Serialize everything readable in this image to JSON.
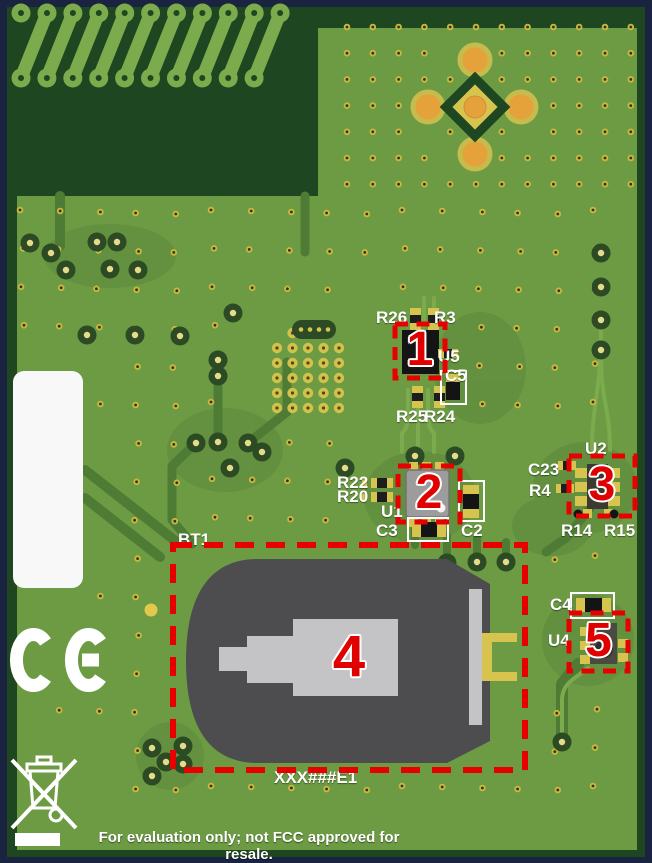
{
  "figure": {
    "description": "Annotated PCB evaluation board photo with five numbered callout regions",
    "bottom_notice": "For evaluation only; not FCC approved for resale.",
    "board_code_label": "XXX###E1"
  },
  "marks": {
    "ce": "CE",
    "weee": "crossed-out-wheeled-bin"
  },
  "colors": {
    "background_navy": "#1a2440",
    "board_dark_green": "#1e4620",
    "board_green": "#6d9b44",
    "trace_light_green": "#7cab4d",
    "trace_dark_green": "#4e7c34",
    "pad_yellow": "#d6c44e",
    "via_yellow": "#c9b83f",
    "button_orange": "#e5a23b",
    "annotation_red": "#e80000",
    "battery_gray": "#4d4d4f",
    "clip_gray": "#c4c4c6",
    "silkscreen_white": "#ffffff"
  },
  "callouts": [
    {
      "number": "1",
      "box": {
        "x": 395,
        "y": 324,
        "w": 50,
        "h": 54
      },
      "num_size": 48,
      "nearby_refdes": [
        "R26",
        "R3",
        "U5",
        "C5",
        "R25",
        "R24"
      ]
    },
    {
      "number": "2",
      "box": {
        "x": 398,
        "y": 466,
        "w": 62,
        "h": 56
      },
      "num_size": 48,
      "nearby_refdes": [
        "R22",
        "R20",
        "U1",
        "C3",
        "C2"
      ]
    },
    {
      "number": "3",
      "box": {
        "x": 569,
        "y": 456,
        "w": 66,
        "h": 60
      },
      "num_size": 48,
      "nearby_refdes": [
        "U2",
        "C23",
        "R4",
        "R14",
        "R15"
      ]
    },
    {
      "number": "4",
      "box": {
        "x": 173,
        "y": 545,
        "w": 352,
        "h": 225
      },
      "num_size": 58,
      "nearby_refdes": [
        "BT1"
      ]
    },
    {
      "number": "5",
      "box": {
        "x": 569,
        "y": 613,
        "w": 59,
        "h": 58
      },
      "num_size": 48,
      "nearby_refdes": [
        "C4",
        "U4"
      ]
    }
  ],
  "silkscreen": {
    "labels": [
      {
        "text": "R26",
        "x": 376,
        "y": 309,
        "size": 17
      },
      {
        "text": "R3",
        "x": 434,
        "y": 309,
        "size": 17
      },
      {
        "text": "U5",
        "x": 438,
        "y": 348,
        "size": 17
      },
      {
        "text": "C5",
        "x": 445,
        "y": 367,
        "size": 17
      },
      {
        "text": "R25",
        "x": 396,
        "y": 408,
        "size": 17
      },
      {
        "text": "R24",
        "x": 424,
        "y": 408,
        "size": 17
      },
      {
        "text": "R22",
        "x": 337,
        "y": 474,
        "size": 17
      },
      {
        "text": "R20",
        "x": 337,
        "y": 488,
        "size": 17
      },
      {
        "text": "U1",
        "x": 381,
        "y": 503,
        "size": 17
      },
      {
        "text": "C3",
        "x": 376,
        "y": 522,
        "size": 17
      },
      {
        "text": "C2",
        "x": 461,
        "y": 522,
        "size": 17
      },
      {
        "text": "U2",
        "x": 585,
        "y": 440,
        "size": 17
      },
      {
        "text": "C23",
        "x": 528,
        "y": 461,
        "size": 17
      },
      {
        "text": "R4",
        "x": 529,
        "y": 482,
        "size": 17
      },
      {
        "text": "R14",
        "x": 561,
        "y": 522,
        "size": 17
      },
      {
        "text": "R15",
        "x": 604,
        "y": 522,
        "size": 17
      },
      {
        "text": "BT1",
        "x": 178,
        "y": 531,
        "size": 17
      },
      {
        "text": "C4",
        "x": 550,
        "y": 596,
        "size": 17
      },
      {
        "text": "U4",
        "x": 548,
        "y": 632,
        "size": 17
      },
      {
        "text": "XXX###E1",
        "x": 274,
        "y": 769,
        "size": 17
      }
    ]
  }
}
